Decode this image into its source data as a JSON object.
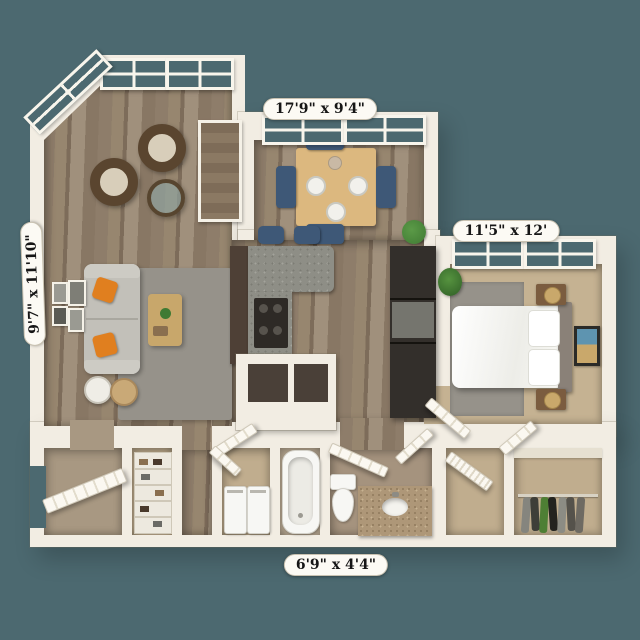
{
  "scene": {
    "type": "3d-apartment-floor-plan-render",
    "background_color": "#4C6970"
  },
  "dimension_labels": {
    "top": "17'9\" x 9'4\"",
    "bedroom": "11'5\" x 12'",
    "left": "9'7\" x 11'10\"",
    "bottom": "6'9\" x 4'4\""
  },
  "palette": {
    "background": "#4C6970",
    "wall": "#F2EDE3",
    "wall_shadow": "#D8D1C1",
    "wood_floor": "#94836F",
    "carpet": "#C5B292",
    "area_rug": "#96928A",
    "sofa": "#C2C0B9",
    "accent_pillow": "#E07F1F",
    "dining_chair": "#3E5877",
    "table_wood": "#DCB87F",
    "countertop_granite": "#8E8E86",
    "cabinet_dark": "#4E4036",
    "appliance_dark": "#332F2B",
    "fixture_white": "#F7F7F4",
    "vanity_granite": "#AE9778",
    "plant": "#3F7A33",
    "window_glass": "#4C6970"
  }
}
